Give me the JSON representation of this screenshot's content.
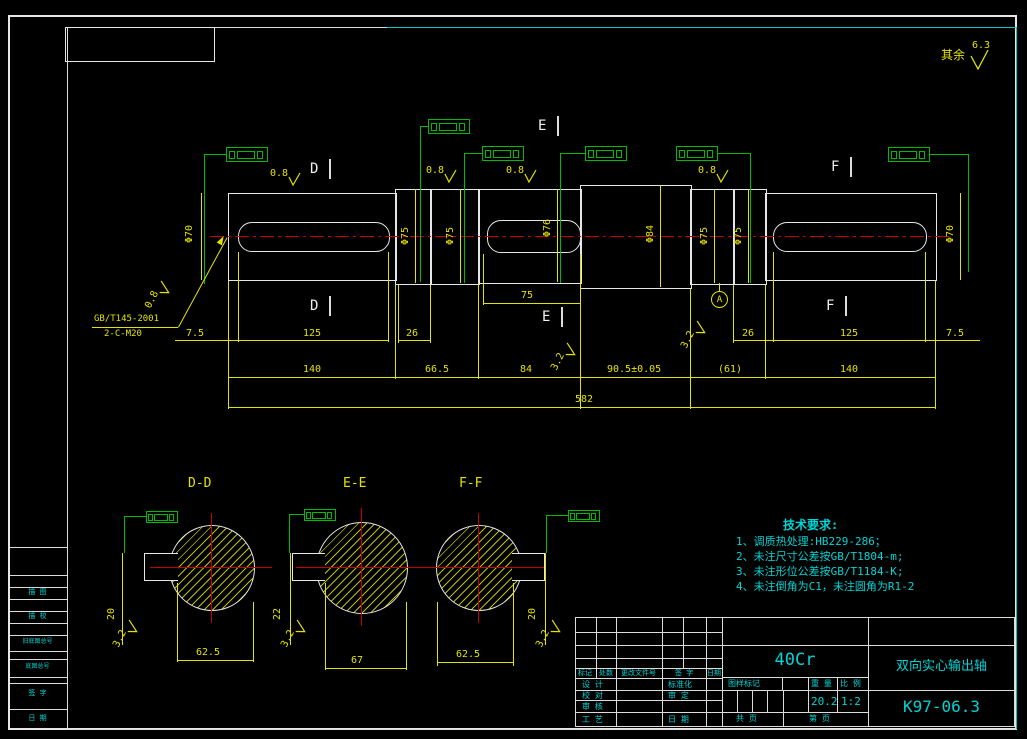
{
  "colors": {
    "background": "#000000",
    "outline": "#e6e6e6",
    "dimension": "#e3e300",
    "centerline": "#c40000",
    "tolerance": "#00bb00",
    "annotation": "#00d4d4"
  },
  "general_roughness": {
    "label": "其余",
    "value": "6.3"
  },
  "thread_note": {
    "line1": "GB/T145-2001",
    "line2": "2-C-M20"
  },
  "roughness": {
    "r08": "0.8",
    "r32": "3.2"
  },
  "datum": "A",
  "cut_labels": {
    "d": "D",
    "e": "E",
    "f": "F"
  },
  "diameters": {
    "left_end": "Φ70",
    "left_step": "Φ75",
    "left_step2": "Φ75",
    "mid_key": "Φ76",
    "center": "Φ84",
    "right_step": "Φ75",
    "right_step2": "Φ75",
    "right_end": "Φ70"
  },
  "dims": {
    "left_end_7_5": "7.5",
    "left_key_125": "125",
    "left_26": "26",
    "mid_key_75": "75",
    "right_26": "26",
    "right_key_125": "125",
    "right_end_7_5": "7.5",
    "seg_140_l": "140",
    "seg_66_5": "66.5",
    "seg_84": "84",
    "seg_90_5": "90.5±0.05",
    "seg_61": "(61)",
    "seg_140_r": "140",
    "total_582": "582"
  },
  "sections": {
    "dd": {
      "label": "D-D",
      "width": "62.5",
      "depth": "20"
    },
    "ee": {
      "label": "E-E",
      "width": "67",
      "depth": "22"
    },
    "ff": {
      "label": "F-F",
      "width": "62.5",
      "depth": "20"
    }
  },
  "tech_req": {
    "title": "技术要求:",
    "item1": "1、调质热处理:HB229-286；",
    "item2": "2、未注尺寸公差按GB/T1804-m;",
    "item3": "3、未注形位公差按GB/T1184-K;",
    "item4": "4、未注倒角为C1，未注圆角为R1-2"
  },
  "title_block": {
    "material": "40Cr",
    "part_name": "双向实心输出轴",
    "drawing_no": "K97-06.3",
    "mark_label": "图样标记",
    "weight_label": "重 量",
    "weight": "20.2",
    "scale_label": "比 例",
    "scale": "1:2",
    "sheet_total": "共    页",
    "sheet_no": "第    页",
    "rev": {
      "h1": "标记",
      "h2": "处数",
      "h3": "更改文件号",
      "h4": "签 字",
      "h5": "日期"
    },
    "roles": {
      "design": "设 计",
      "check": "校 对",
      "review": "审 核",
      "process": "工 艺",
      "standard": "标准化",
      "approve": "审 定",
      "date": "日 期"
    }
  },
  "left_strip": {
    "i1": "描 图",
    "i2": "描 校",
    "i3": "旧底图总号",
    "i4": "底图总号",
    "i5": "签 字",
    "i6": "日 期"
  }
}
